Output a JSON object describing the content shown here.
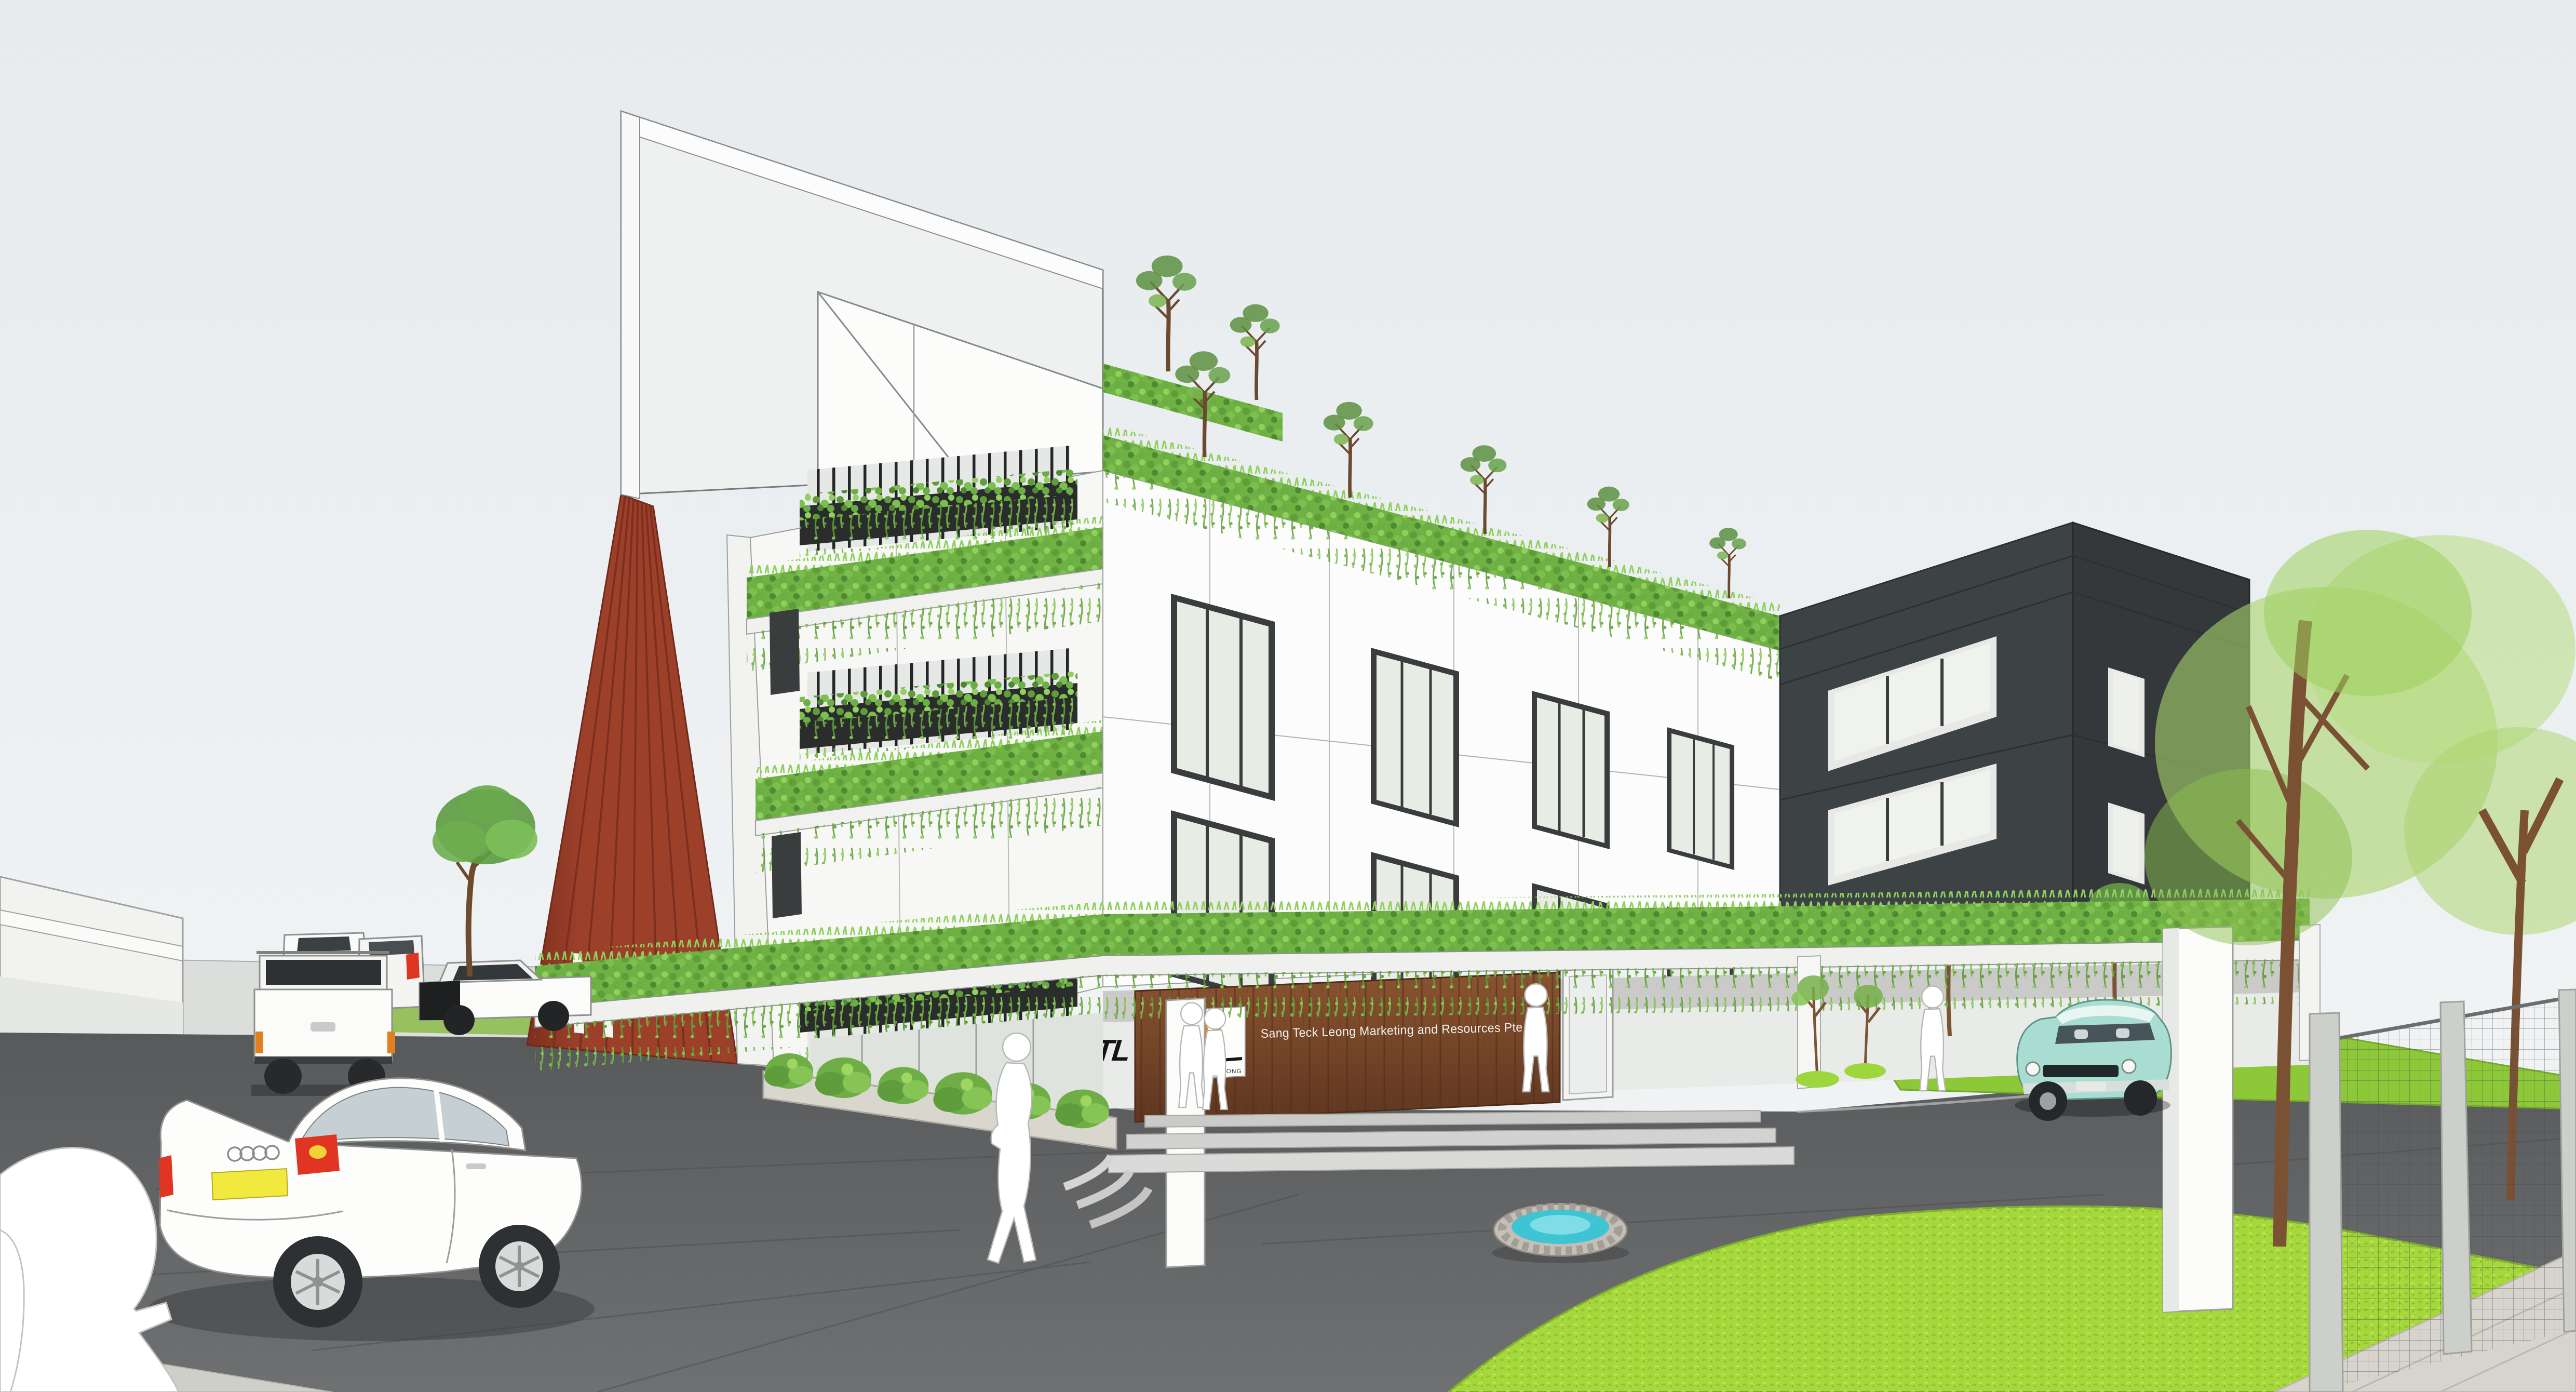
{
  "scene": {
    "type": "architectural-rendering",
    "subject": "Three-storey industrial office building with cascading green facade planters, rooftop trees, red side wall, dark annex block, entrance drop-off plaza with fountain, cars and pedestrian silhouettes"
  },
  "signage": {
    "logo_acronym": "STL",
    "logo_subtext": "SANG TECK LEONG",
    "company_name": "Sang Teck Leong Marketing and Resources Pte Ltd"
  },
  "colors": {
    "sky_top": "#e7ebee",
    "sky_bottom": "#f3f5f6",
    "wall_white": "#f7f8f6",
    "wall_shade": "#e9ebe8",
    "red_wall": "#9c402a",
    "red_wall_dark": "#7d2f1f",
    "wood": "#8a5430",
    "wood_dark": "#5e3620",
    "charcoal_front": "#3d4245",
    "charcoal_side": "#34383b",
    "glass": "#e9ebe5",
    "frame_dark": "#3a3d3e",
    "leaf": "#6fb142",
    "leaf_light": "#8fd05e",
    "leaf_dark": "#4e8a33",
    "lawn": "#a6d83b",
    "asphalt": "#5d5f61",
    "curb": "#d7d8d6",
    "sidewalk": "#d6d4cc",
    "stone": "#c4c0b8",
    "water": "#3fc4d4",
    "plate_yellow": "#f2e93f",
    "taillight_red": "#e03522",
    "logo_orange": "#f07f1a",
    "trunk_brown": "#7b5134",
    "fence_gray": "#cdcfcb",
    "mint_car": "#aaddd2"
  }
}
